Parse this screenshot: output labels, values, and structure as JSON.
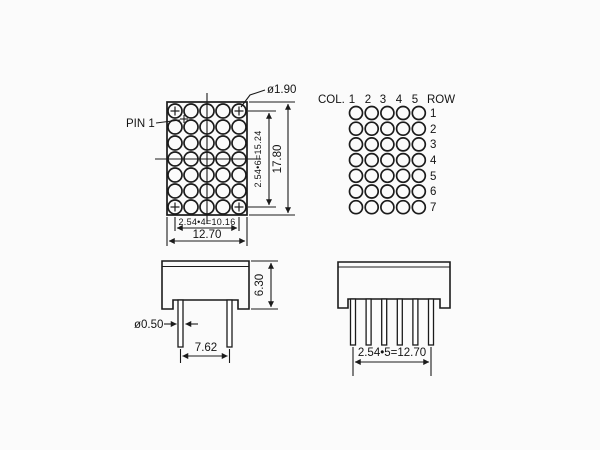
{
  "colors": {
    "ink": "#1b1b1b",
    "paper": "#fbfbfb"
  },
  "front_view": {
    "pin1_label": "PIN 1",
    "dot_diameter_label": "ø1.90",
    "dim_height_inner": "2.54•6=15.24",
    "dim_height_outer": "17.80",
    "dim_width_inner": "2.54•4=10.16",
    "dim_width_outer": "12.70",
    "matrix": {
      "cols": 5,
      "rows": 7
    }
  },
  "pin_map": {
    "col_label": "COL.",
    "col_numbers": [
      "1",
      "2",
      "3",
      "4",
      "5"
    ],
    "row_label": "ROW",
    "row_numbers": [
      "1",
      "2",
      "3",
      "4",
      "5",
      "6",
      "7"
    ],
    "matrix": {
      "cols": 5,
      "rows": 7
    }
  },
  "side_view": {
    "dim_body_height": "6.30",
    "dim_pin_diameter": "ø0.50",
    "dim_pin_spacing": "7.62",
    "pins": 2
  },
  "bottom_view": {
    "dim_pin_row": "2.54•5=12.70",
    "pins": 6
  }
}
